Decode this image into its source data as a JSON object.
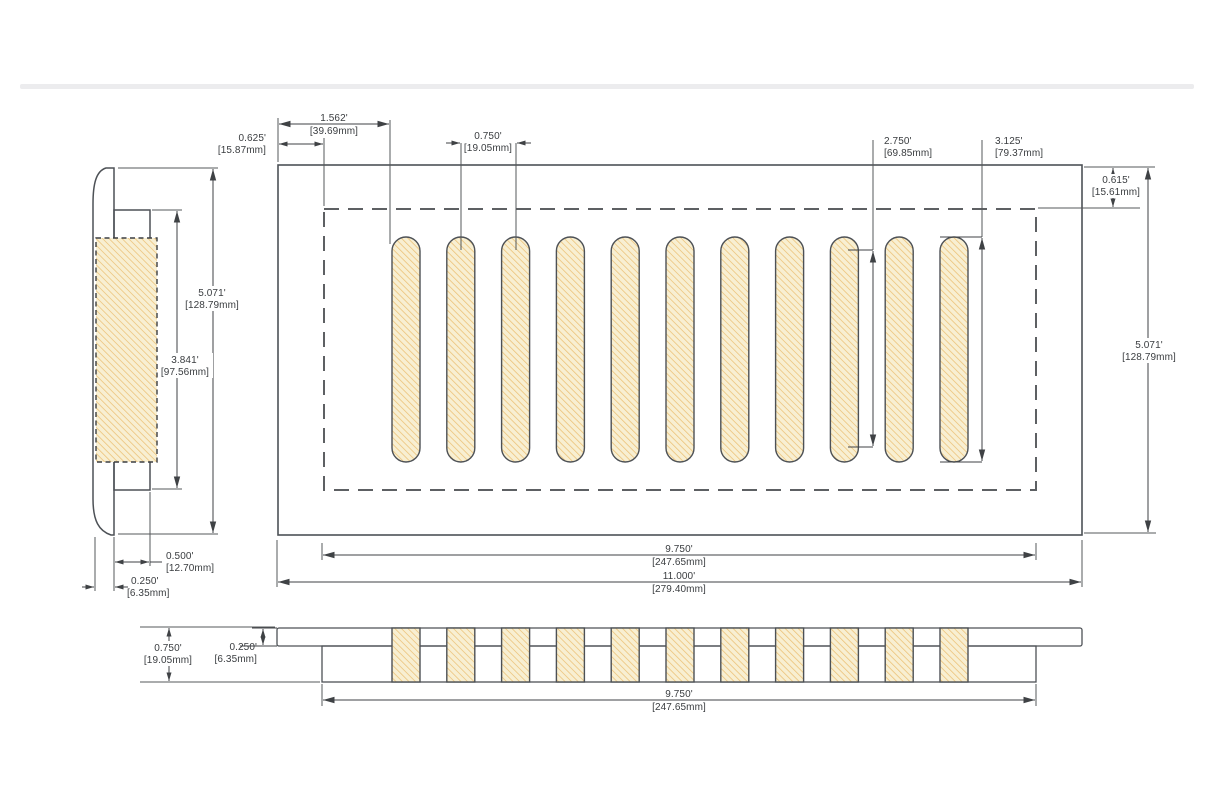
{
  "page": {
    "kind": "technical-dimension-drawing",
    "subject": "floor vent cover with slotted grille, three orthographic views"
  },
  "drawing": {
    "colors": {
      "plate_gray": "#c5c7c9",
      "body_dark_gray": "#8b8d90",
      "slot_fill": "#f8efd2",
      "hatch_stroke": "#ecc47c",
      "outline": "#4d5156",
      "dimension_line": "#3f4245",
      "dashed_line": "#5d6063",
      "divider_band": "#ececee"
    },
    "views": {
      "side": "left side section view",
      "top": "top plan view with 11 slots and dashed duct opening",
      "front": "front elevation view"
    }
  },
  "part": {
    "slot_count": 11
  },
  "dimensions": {
    "slot_offset": {
      "in": "1.562'",
      "mm": "[39.69mm]"
    },
    "opening_side_inset": {
      "in": "0.625'",
      "mm": "[15.87mm]"
    },
    "slot_pitch": {
      "in": "0.750'",
      "mm": "[19.05mm]"
    },
    "slot_inner_length": {
      "in": "2.750'",
      "mm": "[69.85mm]"
    },
    "slot_length": {
      "in": "3.125'",
      "mm": "[79.37mm]"
    },
    "opening_top_inset": {
      "in": "0.615'",
      "mm": "[15.61mm]"
    },
    "overall_height": {
      "in": "5.071'",
      "mm": "[128.79mm]"
    },
    "opening_width": {
      "in": "9.750'",
      "mm": "[247.65mm]"
    },
    "overall_width": {
      "in": "11.000'",
      "mm": "[279.40mm]"
    },
    "side_overall_height": {
      "in": "5.071'",
      "mm": "[128.79mm]"
    },
    "side_body_height": {
      "in": "3.841'",
      "mm": "[97.56mm]"
    },
    "side_body_depth": {
      "in": "0.500'",
      "mm": "[12.70mm]"
    },
    "side_flange_depth": {
      "in": "0.250'",
      "mm": "[6.35mm]"
    },
    "front_total_depth": {
      "in": "0.750'",
      "mm": "[19.05mm]"
    },
    "front_flange_depth": {
      "in": "0.250'",
      "mm": "[6.35mm]"
    },
    "front_body_width": {
      "in": "9.750'",
      "mm": "[247.65mm]"
    }
  }
}
